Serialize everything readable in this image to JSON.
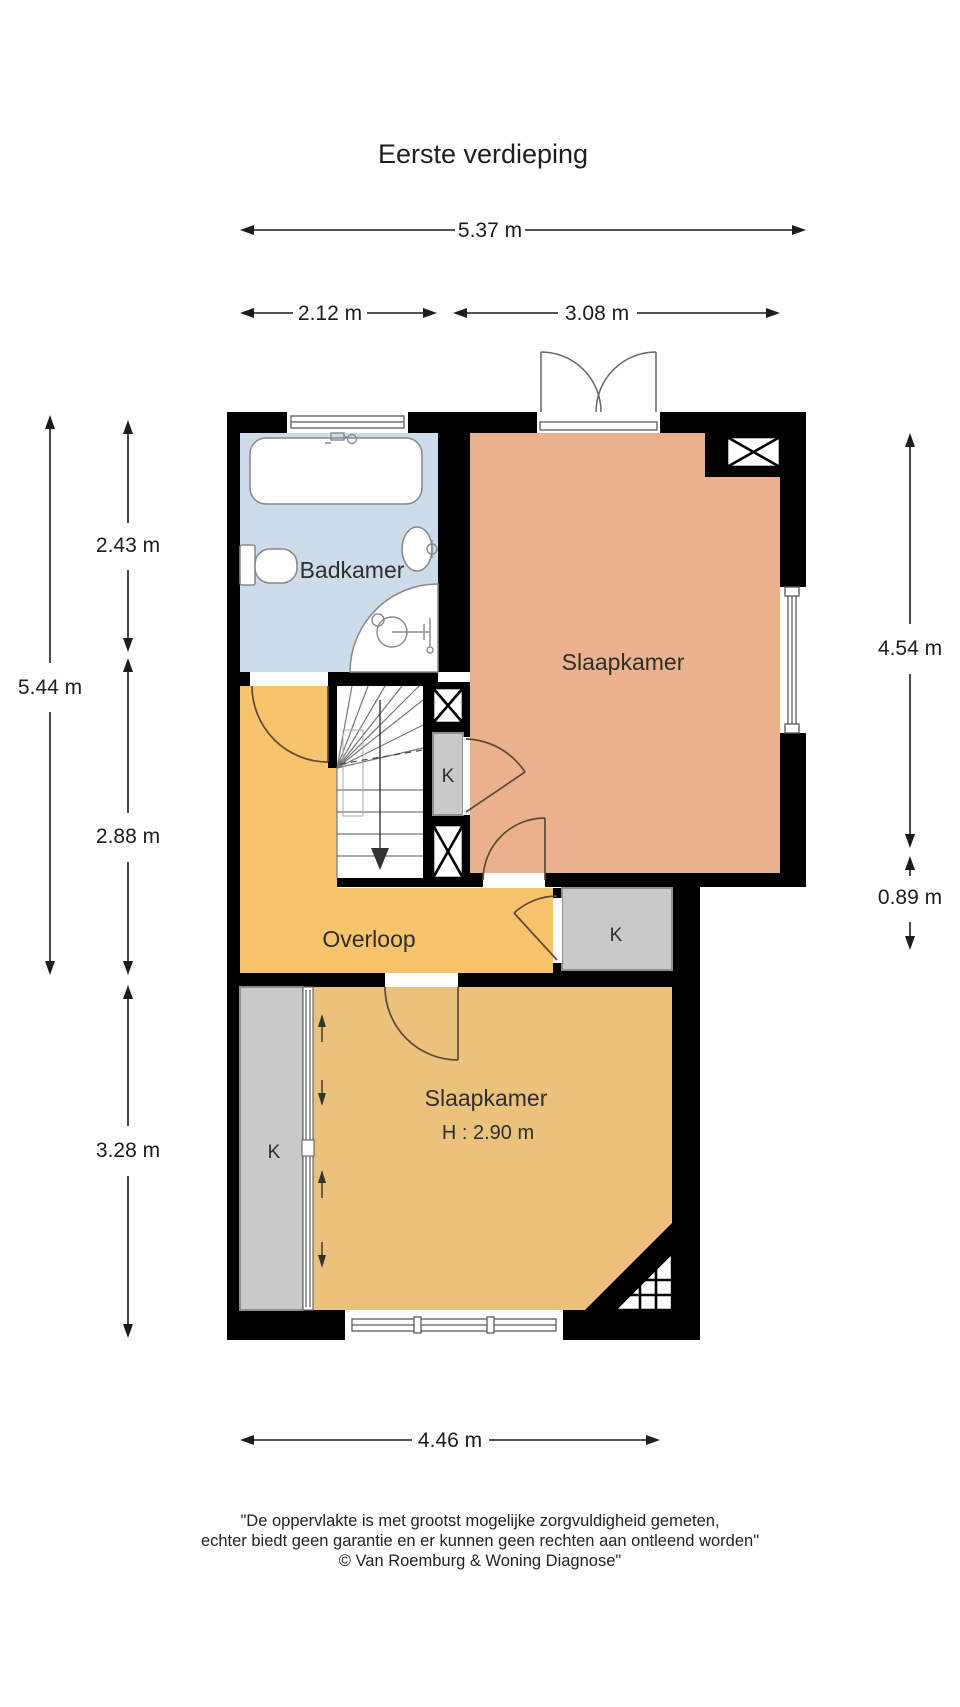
{
  "title": "Eerste verdieping",
  "rooms": {
    "badkamer": "Badkamer",
    "slaapkamer_boven": "Slaapkamer",
    "overloop": "Overloop",
    "slaapkamer_onder": "Slaapkamer",
    "slaapkamer_onder_hoogte": "H : 2.90 m",
    "kast": "K"
  },
  "dimensions": {
    "breedte_totaal": "5.37 m",
    "breedte_links": "2.12 m",
    "breedte_rechts": "3.08 m",
    "hoogte_links_totaal": "5.44 m",
    "hoogte_links_boven": "2.43 m",
    "hoogte_links_midden": "2.88 m",
    "hoogte_links_onder": "3.28 m",
    "hoogte_rechts_boven": "4.54 m",
    "hoogte_rechts_onder": "0.89 m",
    "breedte_onder": "4.46 m"
  },
  "footer": {
    "line1": "\"De oppervlakte is met grootst mogelijke zorgvuldigheid gemeten,",
    "line2": "echter biedt geen garantie en er kunnen geen rechten aan ontleend worden\"",
    "line3": "© Van Roemburg & Woning Diagnose\""
  },
  "colors": {
    "wall": "#000000",
    "badkamer_vloer": "#cddcea",
    "slaapkamer_boven_vloer": "#e9b28d",
    "overloop_vloer": "#f7c36c",
    "slaapkamer_onder_vloer": "#ebc17b",
    "kast_vloer": "#c9c9c9"
  }
}
